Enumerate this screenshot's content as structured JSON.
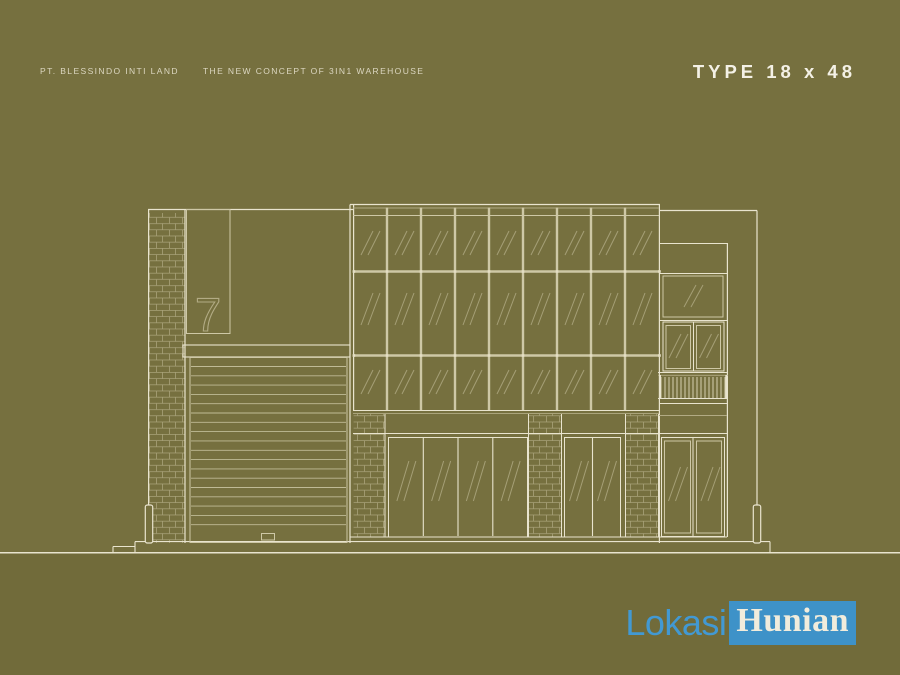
{
  "header": {
    "company": "PT. BLESSINDO INTI LAND",
    "tagline": "THE NEW CONCEPT OF 3IN1 WAREHOUSE",
    "type_label": "TYPE 18 x 48"
  },
  "watermark": {
    "part1": "Lokasi",
    "part2": "Hunian"
  },
  "colors": {
    "background": "#76703F",
    "ground_shade": "#716B3A",
    "line_bright": "#E9E4CE",
    "line_mid": "#CEC8A6",
    "line_dim": "#B2AB84",
    "dot": "#E4DEC4",
    "header_text": "#DCD7C1",
    "title_text": "#F4F1E6",
    "logo_blue": "#3E92C8",
    "logo_text_light": "#4299D3",
    "logo_text_on_blue": "#F1ECDC"
  },
  "elevation": {
    "unit_number": "7",
    "curtain_wall": {
      "columns": 9,
      "rows": 3
    },
    "roller_door_slats": 18,
    "storefront_left_panels": 4,
    "storefront_right_panels": 2,
    "tower_door_panels": 2,
    "balcony_balusters": 17
  }
}
